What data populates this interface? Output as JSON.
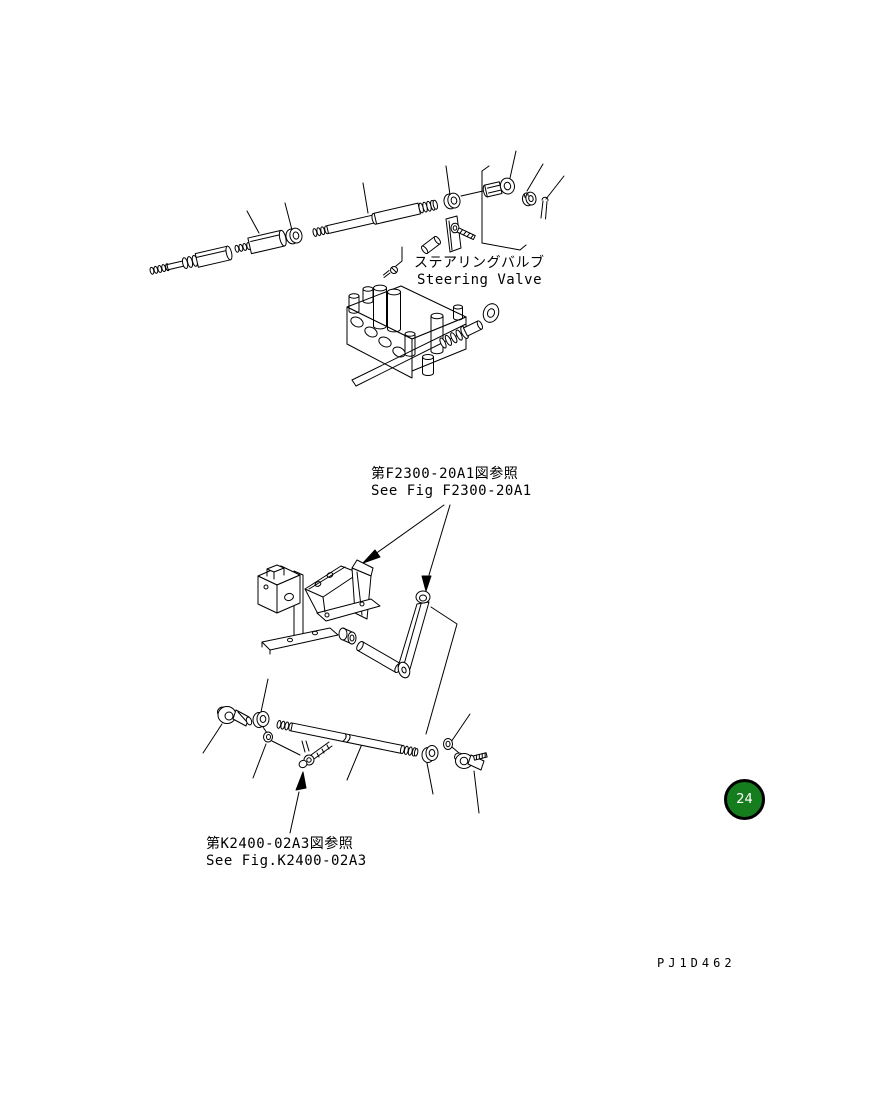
{
  "page": {
    "background_color": "#ffffff",
    "line_color": "#000000",
    "figure_code": "PJ1D462",
    "badge": {
      "number": "24",
      "fill_color": "#157d1d",
      "ring_color": "#000000",
      "text_color": "#ffffff"
    }
  },
  "annotations": {
    "steering_valve": {
      "jp": "ステアリングバルブ",
      "en": "Steering Valve"
    },
    "see_fig_f2300": {
      "jp": "第F2300-20A1図参照",
      "en": "See Fig F2300-20A1"
    },
    "see_fig_k2400": {
      "jp": "第K2400-02A3図参照",
      "en": "See Fig.K2400-02A3"
    }
  },
  "diagram": {
    "type": "exploded-parts-diagram",
    "assemblies": [
      {
        "name": "steering-valve-linkage",
        "parts": [
          "threaded-rod-left",
          "sleeve",
          "lock-nut",
          "tie-rod",
          "lock-nut-2",
          "rod-end-bearing",
          "castle-nut",
          "cotter-pin",
          "mount-bracket",
          "mount-plate-bolt",
          "plug",
          "screw",
          "steering-valve-body",
          "spool-rod",
          "eye-ring"
        ]
      },
      {
        "name": "pedal-bracket-assembly",
        "parts": [
          "mounting-block",
          "support-bracket",
          "pedal-stand",
          "roller",
          "pin-rod",
          "lever-arm"
        ]
      },
      {
        "name": "steering-drag-link",
        "parts": [
          "ball-joint-left",
          "lock-nut-left",
          "washer-left",
          "link-rod",
          "clevis-bolt",
          "lock-nut-right",
          "washer-right",
          "ball-joint-right",
          "clevis-pin"
        ]
      }
    ]
  }
}
